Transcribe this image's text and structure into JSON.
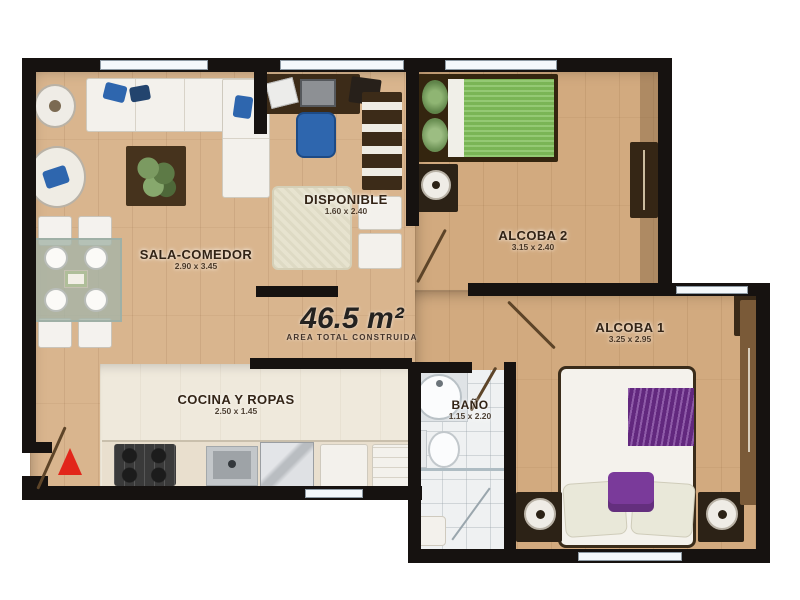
{
  "plan": {
    "area_label": "46.5 m²",
    "area_sublabel": "AREA TOTAL CONSTRUIDA",
    "rooms": [
      {
        "name": "SALA-COMEDOR",
        "dims": "2.90 x 3.45"
      },
      {
        "name": "DISPONIBLE",
        "dims": "1.60 x 2.40"
      },
      {
        "name": "ALCOBA 2",
        "dims": "3.15 x 2.40"
      },
      {
        "name": "ALCOBA 1",
        "dims": "3.25 x 2.95"
      },
      {
        "name": "BAÑO",
        "dims": "1.15 x 2.20"
      },
      {
        "name": "COCINA Y ROPAS",
        "dims": "2.50 x 1.45"
      }
    ],
    "furniture": [
      "l-sofa",
      "armchair",
      "side-table",
      "coffee-table-plant",
      "dining-table",
      "desk",
      "office-chair",
      "bookshelf",
      "storage-boxes",
      "rug",
      "single-bed-green",
      "double-bed",
      "wardrobe",
      "speaker-nightstand",
      "bath-sink",
      "toilet",
      "shower",
      "stove",
      "kitchen-sink",
      "fridge",
      "washer",
      "entry-arrow",
      "door-swing"
    ],
    "colors": {
      "wall": "#161210",
      "wood_floor": "#d9b58e",
      "kitchen_floor": "#efe9dc",
      "bath_floor": "#eff1f2",
      "bed_green": "#80bf5a",
      "accent_purple": "#6f2d90",
      "chair_blue": "#2e66ae",
      "furniture_brown": "#3c2b18",
      "entry_arrow_red": "#e2261a"
    }
  }
}
